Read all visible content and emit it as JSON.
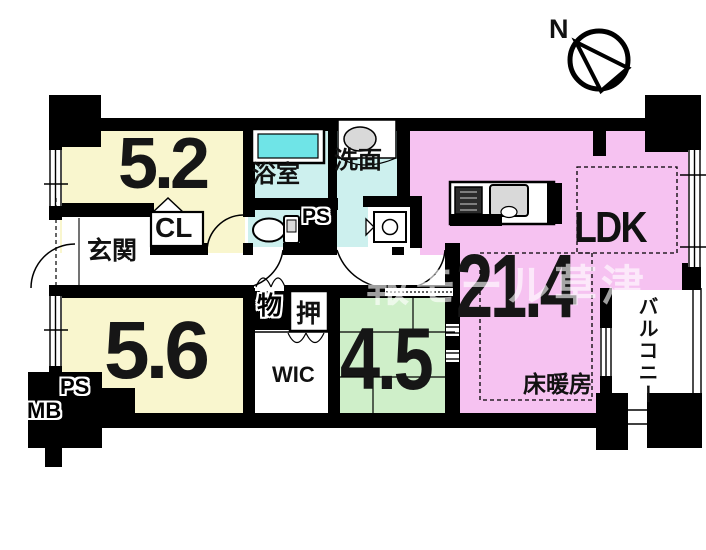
{
  "compass": {
    "label": "N"
  },
  "watermark": {
    "text": "報モール草津"
  },
  "labels": {
    "bedroom1": "5.2",
    "bedroom2": "5.6",
    "ldk": "LDK",
    "ldk_size": "21.4",
    "tatami": "4.5",
    "bath": "浴室",
    "washroom": "洗面",
    "entrance": "玄関",
    "cl": "CL",
    "wic": "WIC",
    "oshiire": "押",
    "storage": "物",
    "ps_top": "PS",
    "ps_bottom": "PS",
    "mb": "MB",
    "floor_heating": "床暖房",
    "balcony": "バルコニー"
  },
  "colors": {
    "room_yellow": "#F9F6CE",
    "room_pink": "#F6C2F1",
    "room_cyan": "#CDF0EE",
    "room_green": "#CFEFC9",
    "tub_water": "#6FE4E7",
    "fixture_gray": "#D9D9D9",
    "wall": "#000000",
    "watermark_white": "rgba(255,255,255,0.62)"
  }
}
